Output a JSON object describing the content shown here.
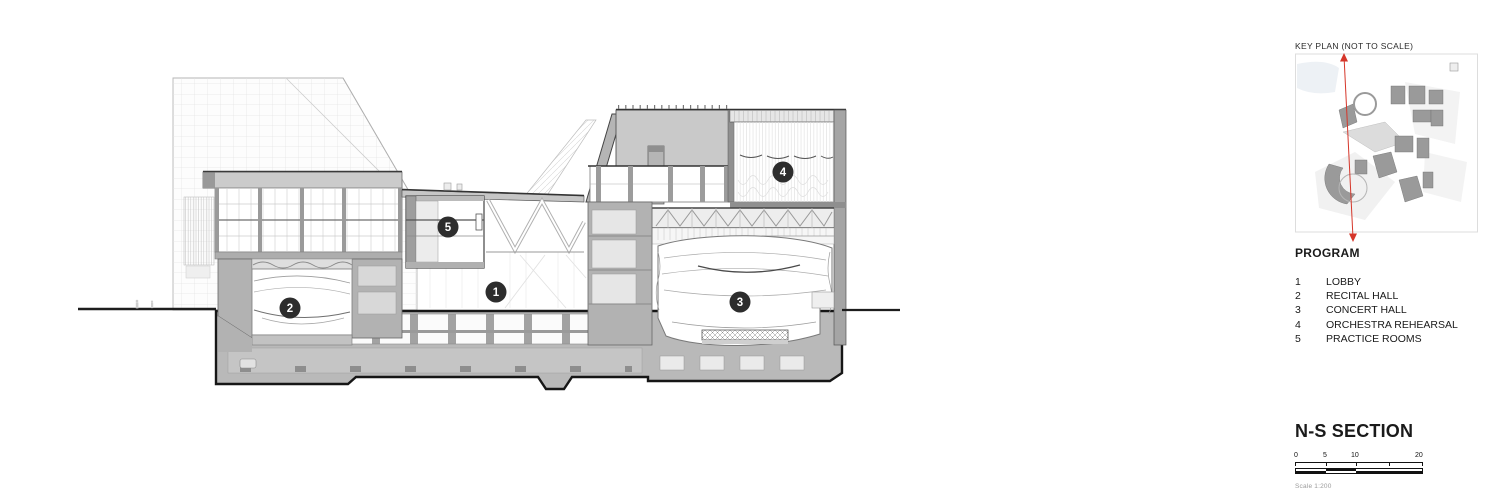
{
  "side_panel": {
    "key_plan": {
      "title": "KEY PLAN (NOT TO SCALE)"
    },
    "program": {
      "title": "PROGRAM",
      "items": [
        {
          "num": "1",
          "label": "LOBBY"
        },
        {
          "num": "2",
          "label": "RECITAL HALL"
        },
        {
          "num": "3",
          "label": "CONCERT HALL"
        },
        {
          "num": "4",
          "label": "ORCHESTRA REHEARSAL"
        },
        {
          "num": "5",
          "label": "PRACTICE ROOMS"
        }
      ]
    },
    "section_title": "N-S SECTION",
    "scale_bar": {
      "labels": [
        "0",
        "5",
        "10",
        "20"
      ],
      "caption": "Scale 1:200"
    }
  },
  "drawing": {
    "markers": [
      {
        "num": "1"
      },
      {
        "num": "2"
      },
      {
        "num": "3"
      },
      {
        "num": "4"
      },
      {
        "num": "5"
      }
    ],
    "colors": {
      "marker_bg": "#2d2d2d",
      "section_cut_red": "#d5362a"
    }
  }
}
